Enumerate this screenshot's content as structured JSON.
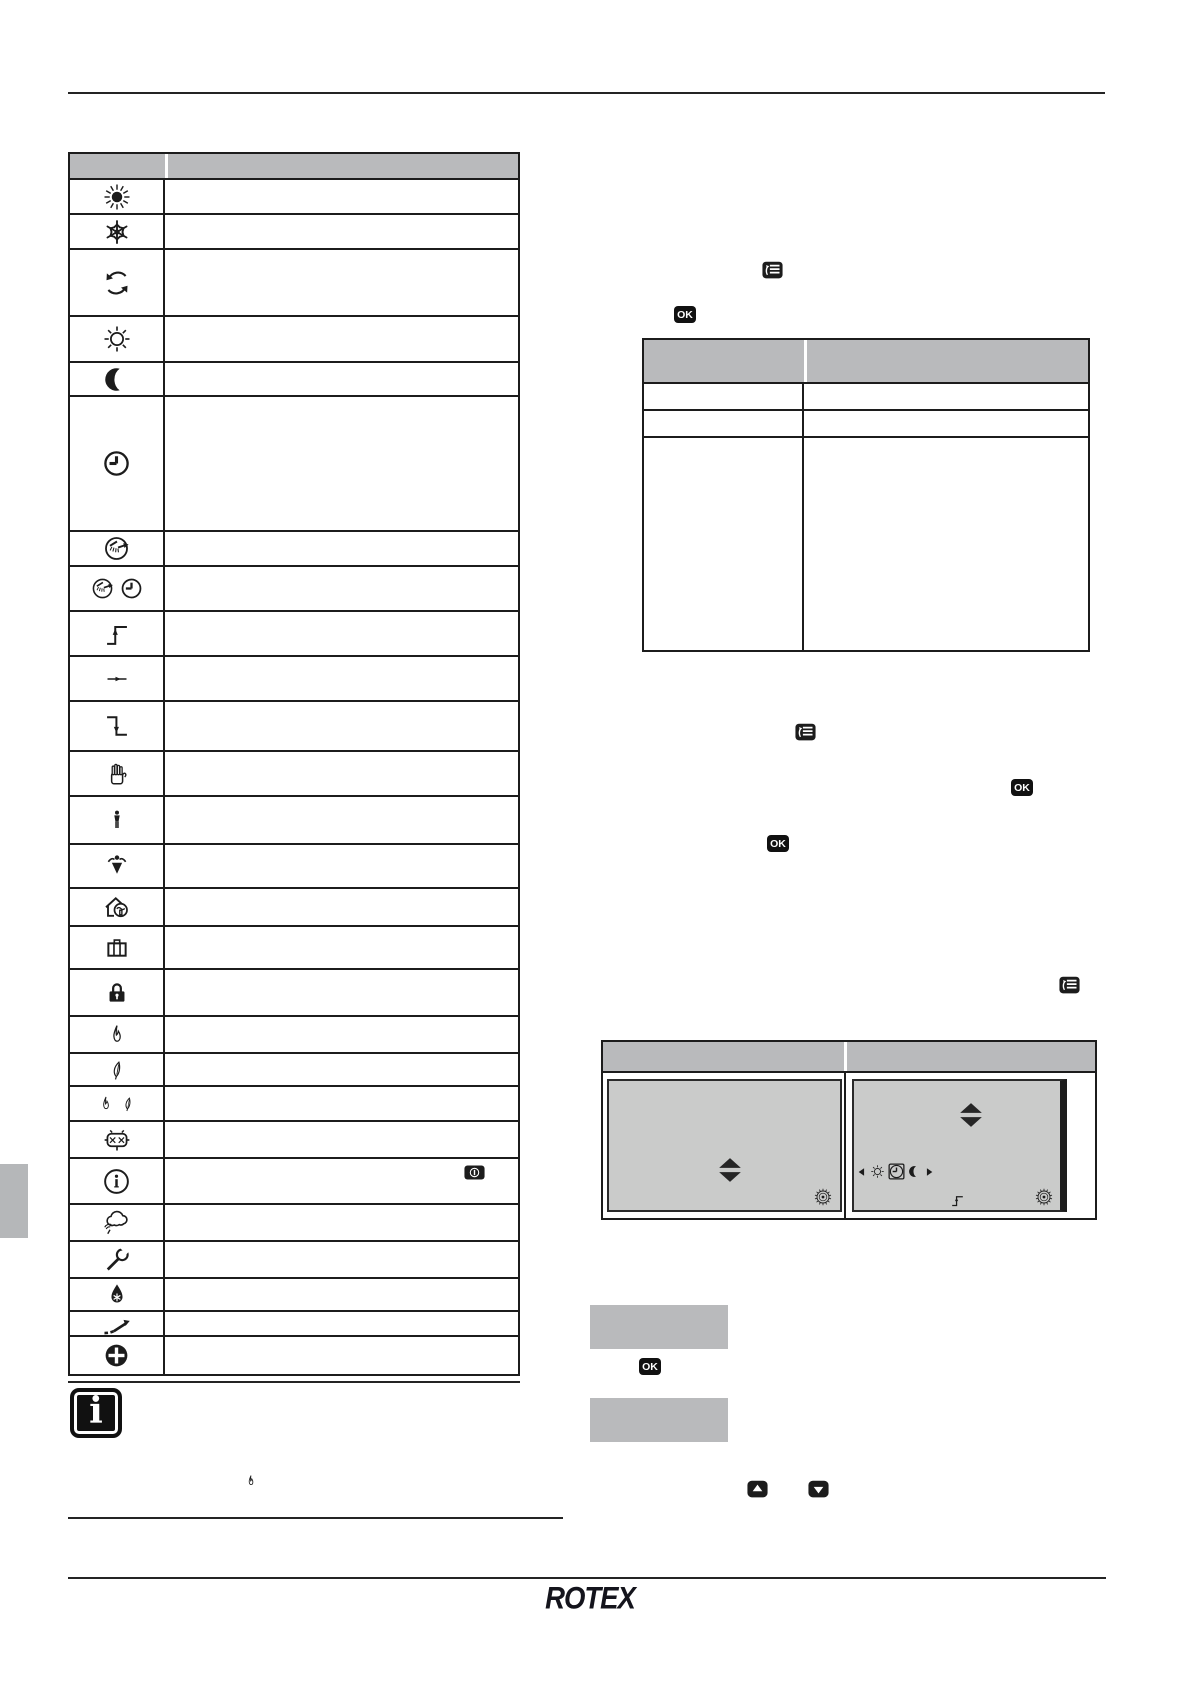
{
  "colors": {
    "ink": "#1c1c1c",
    "table_header_gray": "#b9babc",
    "screen_gray": "#cacbca",
    "sidebar_tab_gray": "#b5b7b9"
  },
  "document": {
    "brand_logo": "ROTEX",
    "ok_button_label": "OK",
    "info_note_symbol": "i",
    "burner_fault_label": "××"
  },
  "symbol_table": {
    "col_headers": [
      "",
      ""
    ],
    "rows": [
      {
        "icon": "sun-filled-icon",
        "desc": ""
      },
      {
        "icon": "snowflake-icon",
        "desc": ""
      },
      {
        "icon": "defrost-rotate-icon",
        "desc": ""
      },
      {
        "icon": "sun-outline-icon",
        "desc": ""
      },
      {
        "icon": "moon-icon",
        "desc": ""
      },
      {
        "icon": "clock-icon",
        "desc": ""
      },
      {
        "icon": "dhw-boost-icon",
        "desc": ""
      },
      {
        "icon": "dhw-clock-icon",
        "desc": ""
      },
      {
        "icon": "step-up-icon",
        "desc": ""
      },
      {
        "icon": "arrow-continuous-icon",
        "desc": ""
      },
      {
        "icon": "step-down-icon",
        "desc": ""
      },
      {
        "icon": "hand-icon",
        "desc": ""
      },
      {
        "icon": "person-icon",
        "desc": ""
      },
      {
        "icon": "person-absent-icon",
        "desc": ""
      },
      {
        "icon": "house-ventilation-icon",
        "desc": ""
      },
      {
        "icon": "briefcase-icon",
        "desc": ""
      },
      {
        "icon": "lock-icon",
        "desc": ""
      },
      {
        "icon": "flame-icon",
        "desc": ""
      },
      {
        "icon": "leaf-icon",
        "desc": ""
      },
      {
        "icon": "flame-leaf-icon",
        "desc": ""
      },
      {
        "icon": "burner-fault-icon",
        "desc": ""
      },
      {
        "icon": "info-circle-icon",
        "desc": "",
        "desc_icon": "rotary-info-badge"
      },
      {
        "icon": "cloud-signal-icon",
        "desc": ""
      },
      {
        "icon": "wrench-icon",
        "desc": ""
      },
      {
        "icon": "drop-snowflake-icon",
        "desc": ""
      },
      {
        "icon": "ramp-arrow-icon",
        "desc": ""
      },
      {
        "icon": "plus-circle-icon",
        "desc": ""
      }
    ]
  },
  "mode_table": {
    "col_headers": [
      "",
      ""
    ],
    "rows": [
      {
        "c1": "",
        "c2": ""
      },
      {
        "c1": "",
        "c2": ""
      },
      {
        "c1": "",
        "c2": ""
      }
    ]
  },
  "figure_table": {
    "col_headers": [
      "",
      ""
    ],
    "right_screen_icon_row": [
      "tri-left-icon",
      "sun-outline-small-icon",
      "clock-boxed-icon",
      "moon-small-icon",
      "tri-right-icon"
    ]
  },
  "display_boxes": {
    "box1": "",
    "box2": ""
  }
}
